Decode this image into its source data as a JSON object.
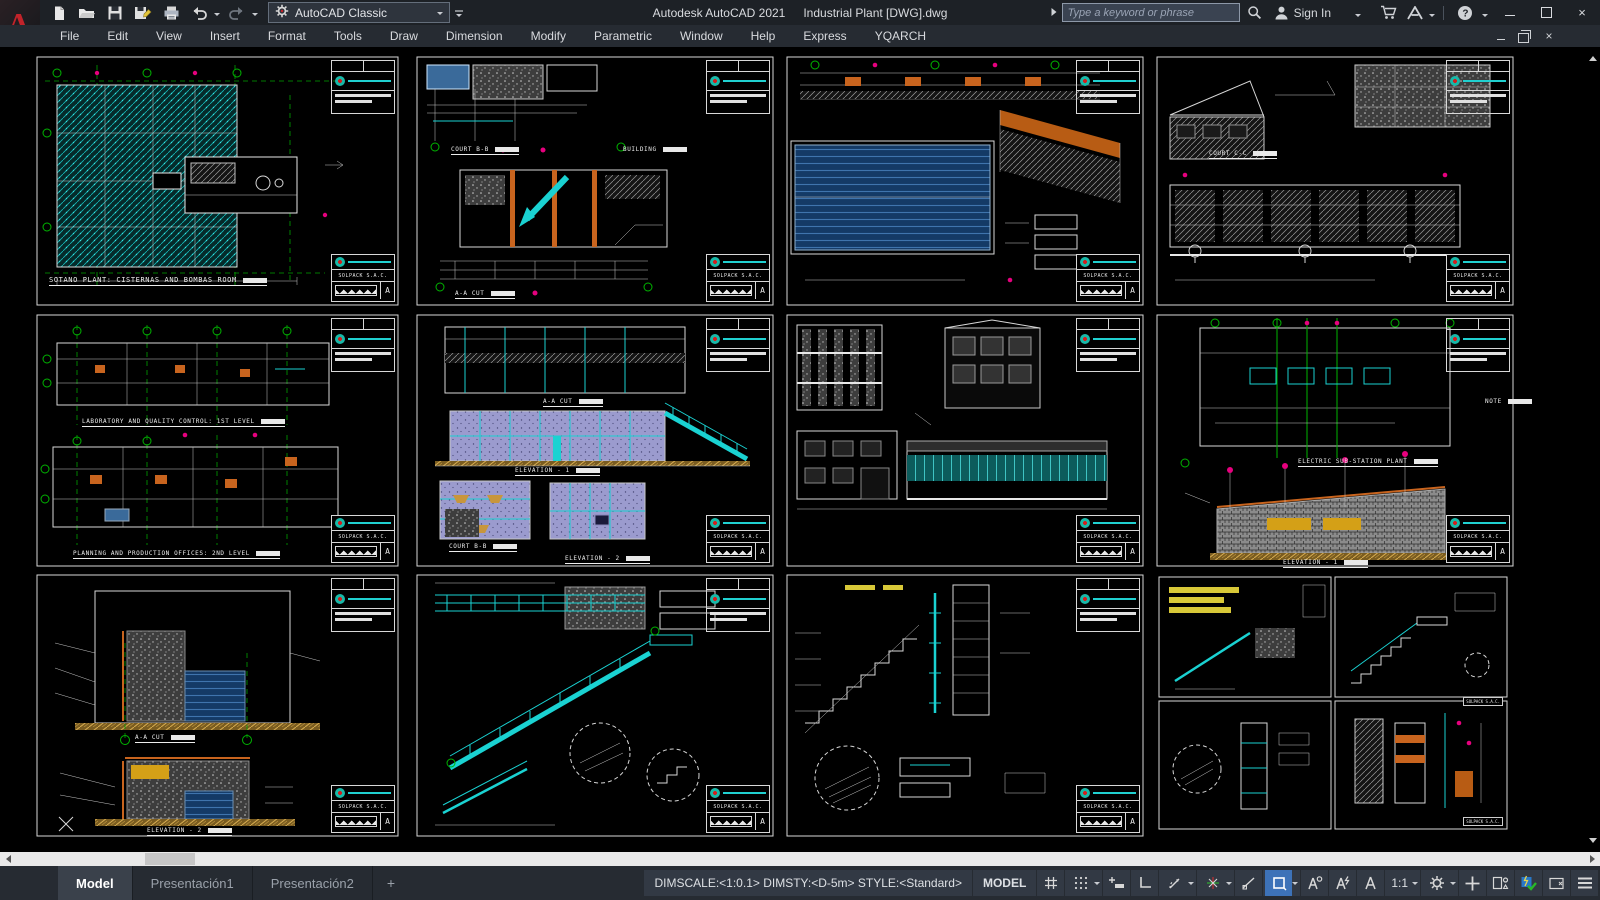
{
  "titlebar": {
    "app_title": "Autodesk AutoCAD 2021",
    "doc_title": "Industrial Plant [DWG].dwg",
    "workspace": "AutoCAD Classic",
    "search_placeholder": "Type a keyword or phrase",
    "signin_label": "Sign In"
  },
  "menubar": {
    "items": [
      "File",
      "Edit",
      "View",
      "Insert",
      "Format",
      "Tools",
      "Draw",
      "Dimension",
      "Modify",
      "Parametric",
      "Window",
      "Help",
      "Express",
      "YQARCH"
    ]
  },
  "tabs": {
    "items": [
      "Model",
      "Presentación1",
      "Presentación2"
    ],
    "active": "Model",
    "add_label": "+"
  },
  "statusbar": {
    "dim_info": "DIMSCALE:<1:0.1> DIMSTY:<D-5m> STYLE:<Standard>",
    "model_label": "MODEL",
    "scale_label": "1:1"
  },
  "colors": {
    "accent_blue": "#3d72b8",
    "cad_cyan": "#1ad2d2",
    "cad_green": "#00b400",
    "cad_magenta": "#e6007e",
    "cad_orange": "#c8641e"
  },
  "sheets": [
    {
      "titleblock": "SOLPACK S.A.C.",
      "rev": "A",
      "labels": [
        "SOTANO PLANT: CISTERNAS AND BOMBAS ROOM"
      ]
    },
    {
      "titleblock": "SOLPACK S.A.C.",
      "rev": "A",
      "labels": [
        "COURT B-B",
        "BUILDING",
        "A-A CUT"
      ]
    },
    {
      "titleblock": "SOLPACK S.A.C.",
      "rev": "A",
      "labels": []
    },
    {
      "titleblock": "SOLPACK S.A.C.",
      "rev": "A",
      "labels": [
        "COURT C-C"
      ]
    },
    {
      "titleblock": "SOLPACK S.A.C.",
      "rev": "A",
      "labels": [
        "LABORATORY AND QUALITY CONTROL: 1ST LEVEL",
        "PLANNING AND PRODUCTION OFFICES: 2ND LEVEL"
      ]
    },
    {
      "titleblock": "SOLPACK S.A.C.",
      "rev": "A",
      "labels": [
        "A-A CUT",
        "ELEVATION - 1",
        "COURT B-B",
        "ELEVATION - 2"
      ]
    },
    {
      "titleblock": "SOLPACK S.A.C.",
      "rev": "A",
      "labels": []
    },
    {
      "titleblock": "SOLPACK S.A.C.",
      "rev": "A",
      "labels": [
        "ELECTRIC SUB-STATION PLANT",
        "ELEVATION - 1",
        "NOTE"
      ]
    },
    {
      "titleblock": "SOLPACK S.A.C.",
      "rev": "A",
      "labels": [
        "A-A CUT",
        "ELEVATION - 2"
      ]
    },
    {
      "titleblock": "SOLPACK S.A.C.",
      "rev": "A",
      "labels": []
    },
    {
      "titleblock": "SOLPACK S.A.C.",
      "rev": "A",
      "labels": []
    },
    {
      "titleblock": "SOLPACK S.A.C.",
      "rev": "A",
      "labels": []
    }
  ]
}
